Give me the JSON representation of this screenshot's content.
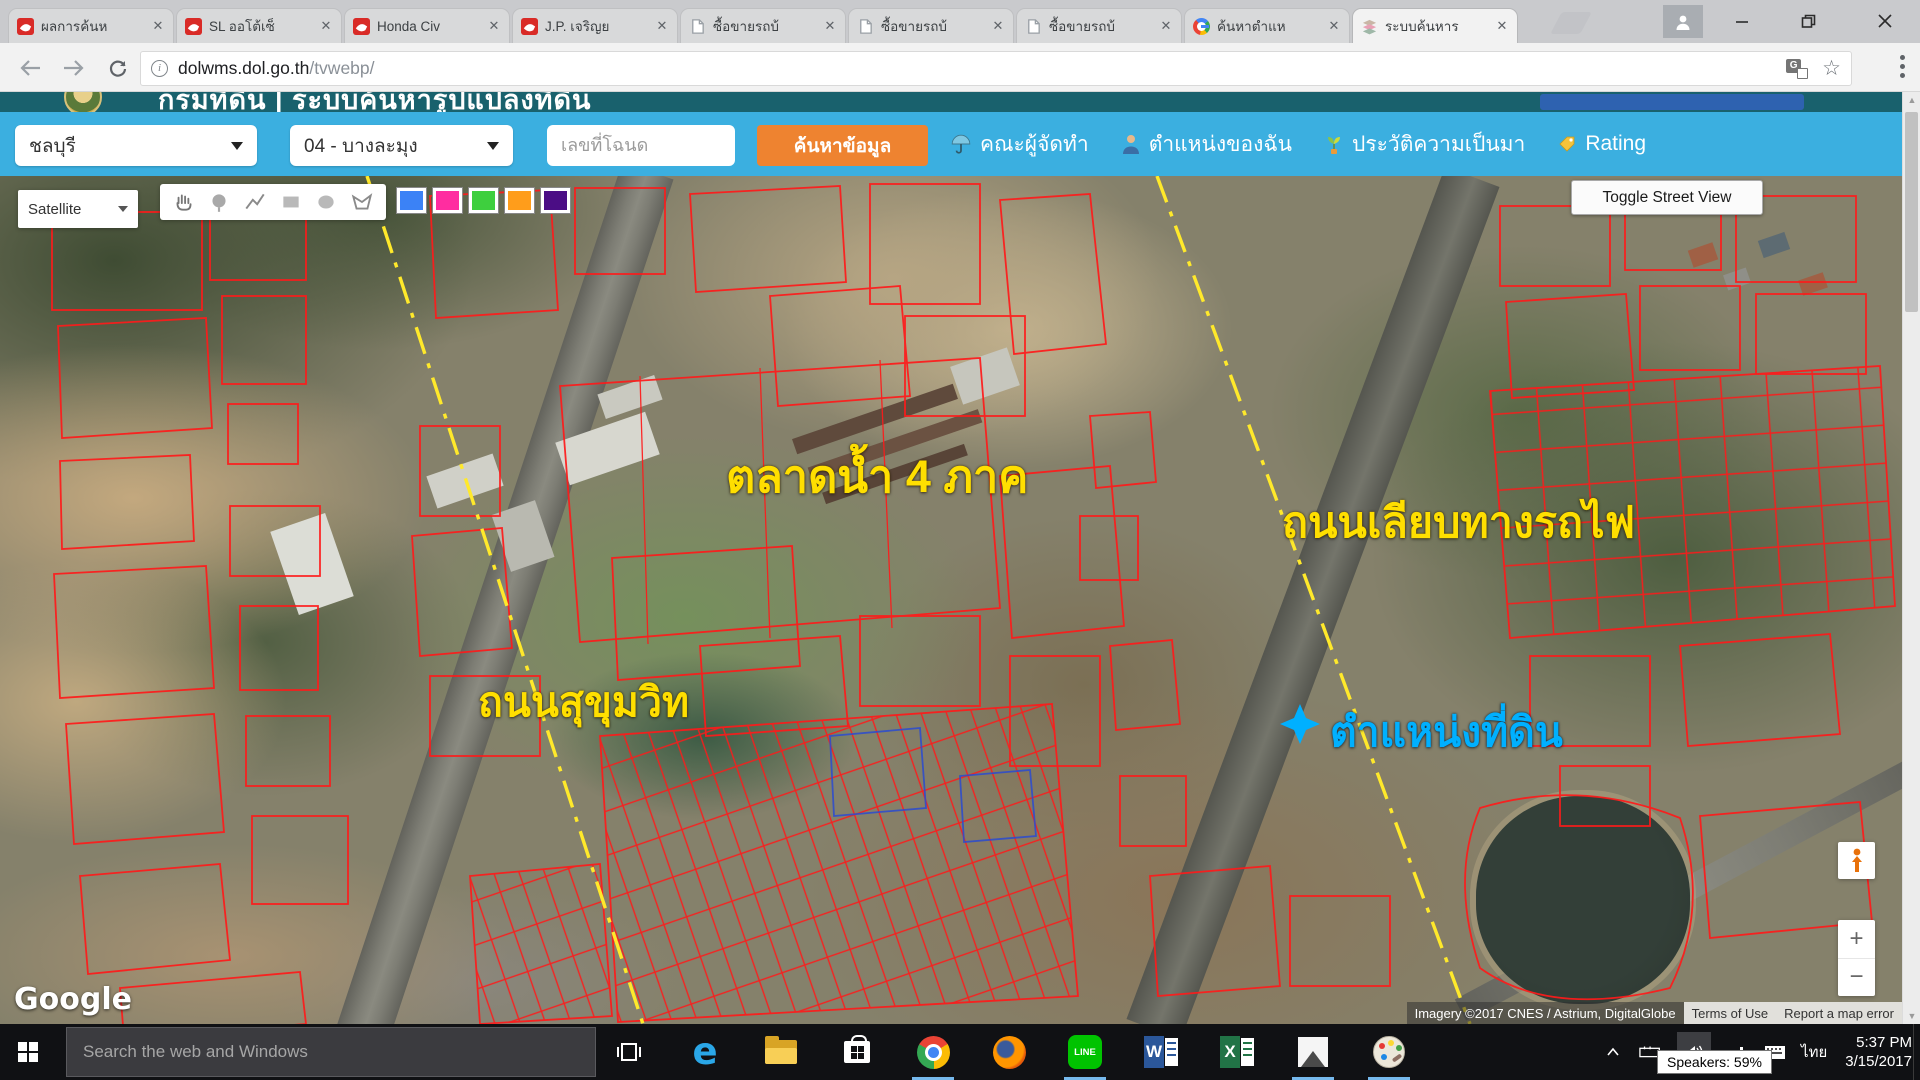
{
  "browser": {
    "tabs": [
      {
        "title": "ผลการค้นห",
        "icon": "car-favicon"
      },
      {
        "title": "SL ออโต้เซ็",
        "icon": "car-favicon"
      },
      {
        "title": "Honda Civ",
        "icon": "car-favicon"
      },
      {
        "title": "J.P. เจริญย",
        "icon": "car-favicon"
      },
      {
        "title": "ซื้อขายรถบ้",
        "icon": "page-favicon"
      },
      {
        "title": "ซื้อขายรถบ้",
        "icon": "page-favicon"
      },
      {
        "title": "ซื้อขายรถบ้",
        "icon": "page-favicon"
      },
      {
        "title": "ค้นหาตำแห",
        "icon": "google-favicon"
      },
      {
        "title": "ระบบค้นหาร",
        "icon": "layers-favicon"
      }
    ],
    "url_host": "dolwms.dol.go.th",
    "url_path": "/tvwebp/"
  },
  "site": {
    "title": "กรมที่ดิน | ระบบค้นหารูปแปลงที่ดิน",
    "province": "ชลบุรี",
    "district": "04 - บางละมุง",
    "deed_placeholder": "เลขที่โฉนด",
    "search_button": "ค้นหาข้อมูล",
    "menu": [
      {
        "label": "คณะผู้จัดทำ",
        "icon": "umbrella-icon"
      },
      {
        "label": "ตำแหน่งของฉัน",
        "icon": "person-icon"
      },
      {
        "label": "ประวัติความเป็นมา",
        "icon": "seedling-icon"
      },
      {
        "label": "Rating",
        "icon": "tag-icon"
      }
    ],
    "accent_cyan": "#3bafe0",
    "accent_orange": "#ee8330"
  },
  "map": {
    "type_selector": "Satellite",
    "street_view_button": "Toggle Street View",
    "draw_colors": [
      "#3b82f6",
      "#ff2da0",
      "#3ecf3e",
      "#ff9d1b",
      "#4b0d85"
    ],
    "parcel_color": "#ff1a1a",
    "road_line_color": "#ffe92b",
    "labels": {
      "market": "ตลาดน้ำ 4 ภาค",
      "railway_road": "ถนนเลียบทางรถไฟ",
      "sukhumvit_road": "ถนนสุขุมวิท",
      "land_position": "ตำแหน่งที่ดิน"
    },
    "label_color": "#ffdf00",
    "highlight_color": "#00b0ff",
    "google_logo": "Google",
    "attribution": {
      "imagery": "Imagery ©2017 CNES / Astrium, DigitalGlobe",
      "terms": "Terms of Use",
      "report": "Report a map error"
    },
    "zoom_in": "+",
    "zoom_out": "−"
  },
  "taskbar": {
    "search_placeholder": "Search the web and Windows",
    "line_label": "LINE",
    "word_label": "W",
    "excel_label": "X",
    "tooltip": "Speakers: 59%",
    "language": "ไทย",
    "time": "5:37 PM",
    "date": "3/15/2017"
  }
}
